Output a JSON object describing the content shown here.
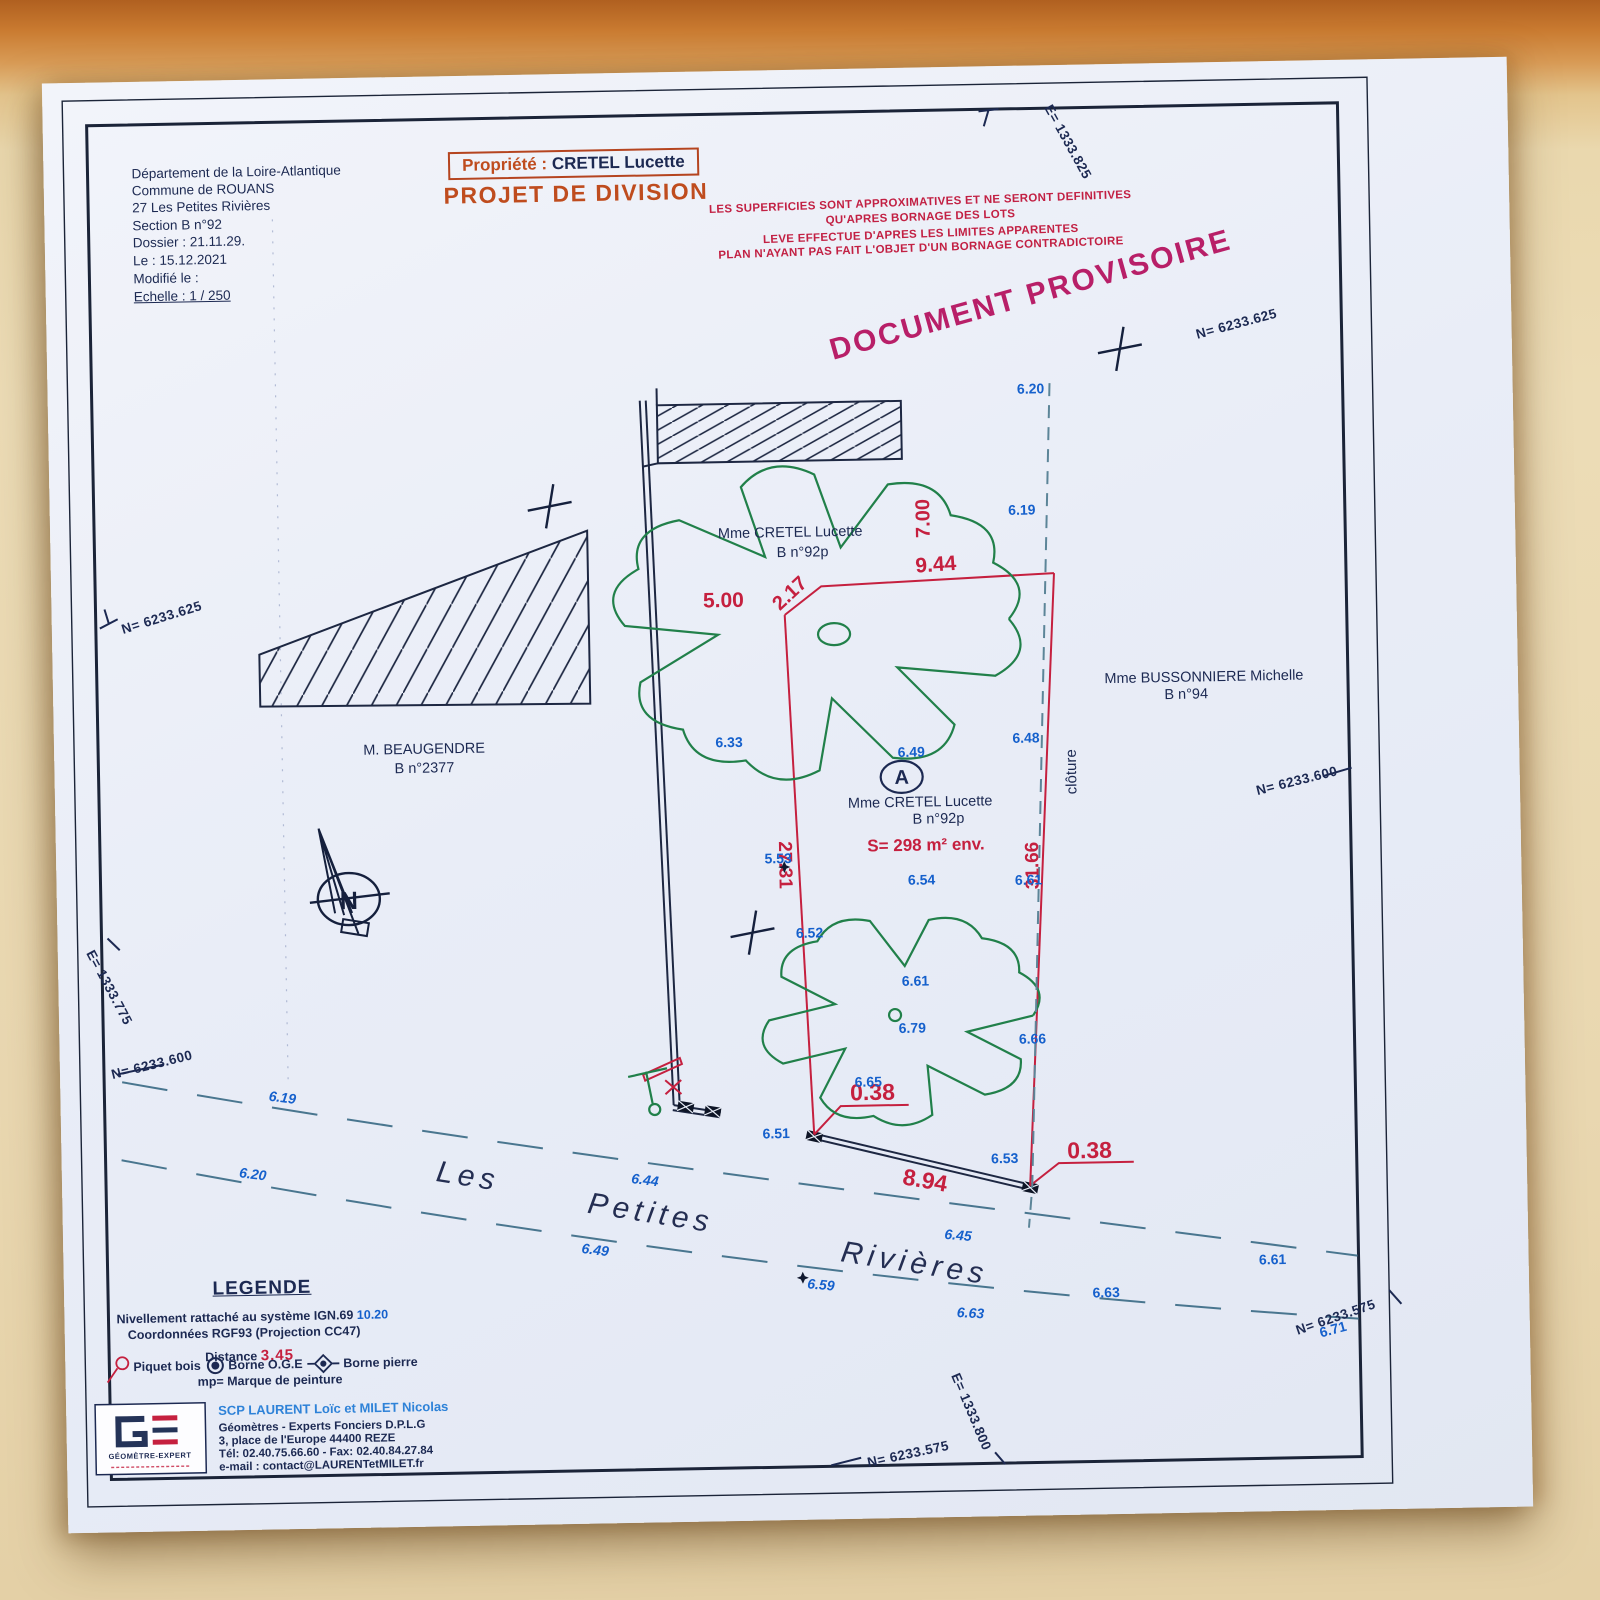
{
  "header": {
    "lines": [
      "Département de la Loire-Atlantique",
      "Commune de ROUANS",
      "27 Les Petites Rivières",
      "Section B n°92",
      "Dossier : 21.11.29.",
      "Le : 15.12.2021",
      "Modifié le :",
      "Echelle : 1 / 250"
    ]
  },
  "property_box": {
    "label": "Propriété :",
    "owner": "CRETEL  Lucette"
  },
  "title": "PROJET DE DIVISION",
  "disclaimer": {
    "l1": "LES SUPERFICIES SONT APPROXIMATIVES ET NE SERONT DEFINITIVES",
    "l2": "QU'APRES BORNAGE DES LOTS",
    "l3": "LEVE  EFFECTUE  D'APRES  LES  LIMITES  APPARENTES",
    "l4": "PLAN  N'AYANT  PAS  FAIT  L'OBJET  D'UN  BORNAGE  CONTRADICTOIRE"
  },
  "stamp": "DOCUMENT   PROVISOIRE",
  "parcels": {
    "cretel_top": {
      "owner": "Mme CRETEL Lucette",
      "ref": "B n°92p"
    },
    "cretel_lot": {
      "owner": "Mme CRETEL Lucette",
      "ref": "B n°92p",
      "area": "S= 298 m² env.",
      "label": "A"
    },
    "beaugendre": {
      "owner": "M. BEAUGENDRE",
      "ref": "B n°2377"
    },
    "bussonniere": {
      "owner": "Mme BUSSONNIERE Michelle",
      "ref": "B n°94"
    },
    "fence_label": "clôture"
  },
  "street": {
    "w1": "Les",
    "w2": "Petites",
    "w3": "Rivières"
  },
  "dims": {
    "d700": "7.00",
    "d944": "9.44",
    "d500": "5.00",
    "d217": "2.17",
    "d2731": "27.31",
    "d3166": "31.66",
    "d038a": "0.38",
    "d894": "8.94",
    "d038b": "0.38"
  },
  "elev": [
    "6.20",
    "6.19",
    "6.33",
    "6.49",
    "6.48",
    "6.54",
    "5.53",
    "6.61",
    "6.52",
    "6.61",
    "6.79",
    "6.66",
    "6.65",
    "6.51",
    "6.53",
    "6.19",
    "6.20",
    "6.44",
    "6.49",
    "6.45",
    "6.59",
    "6.63",
    "6.63",
    "6.61",
    "6.71"
  ],
  "coords": {
    "e825": "E= 1333.825",
    "n625": "N= 6233.625",
    "n600": "N= 6233.600",
    "e775": "E= 1333.775",
    "n575": "N= 6233.575",
    "e800": "E= 1333.800"
  },
  "legend": {
    "title": "LEGENDE",
    "niv_label": "Nivellement rattaché au système IGN.69",
    "niv_value": "10.20",
    "coord_line": "Coordonnées RGF93 (Projection CC47)",
    "dist_label": "Distance",
    "dist_value": "3.45",
    "sym_piquet": "Piquet bois",
    "sym_oge": "Borne O.G.E",
    "sym_pierre": "Borne pierre",
    "mp_line": "mp=  Marque de peinture"
  },
  "firm": {
    "logo_text": "GÉOMÈTRE-EXPERT",
    "name": "SCP LAURENT Loïc et MILET Nicolas",
    "line1": "Géomètres - Experts Fonciers D.P.L.G",
    "line2": "3, place de l'Europe  44400  REZE",
    "line3": "Tél: 02.40.75.66.60  -  Fax: 02.40.84.27.84",
    "line4": "e-mail : contact@LAURENTetMILET.fr"
  },
  "compass": {
    "letter": "N"
  },
  "colors": {
    "ink_navy": "#1c2952",
    "dim_red": "#c5203f",
    "elev_blue": "#1560cc",
    "tree_green": "#21804a",
    "title_orange": "#bf4c1e",
    "stamp_magenta": "#b81f68",
    "firm_blue": "#2e82d8",
    "street_dash": "#49768f"
  }
}
